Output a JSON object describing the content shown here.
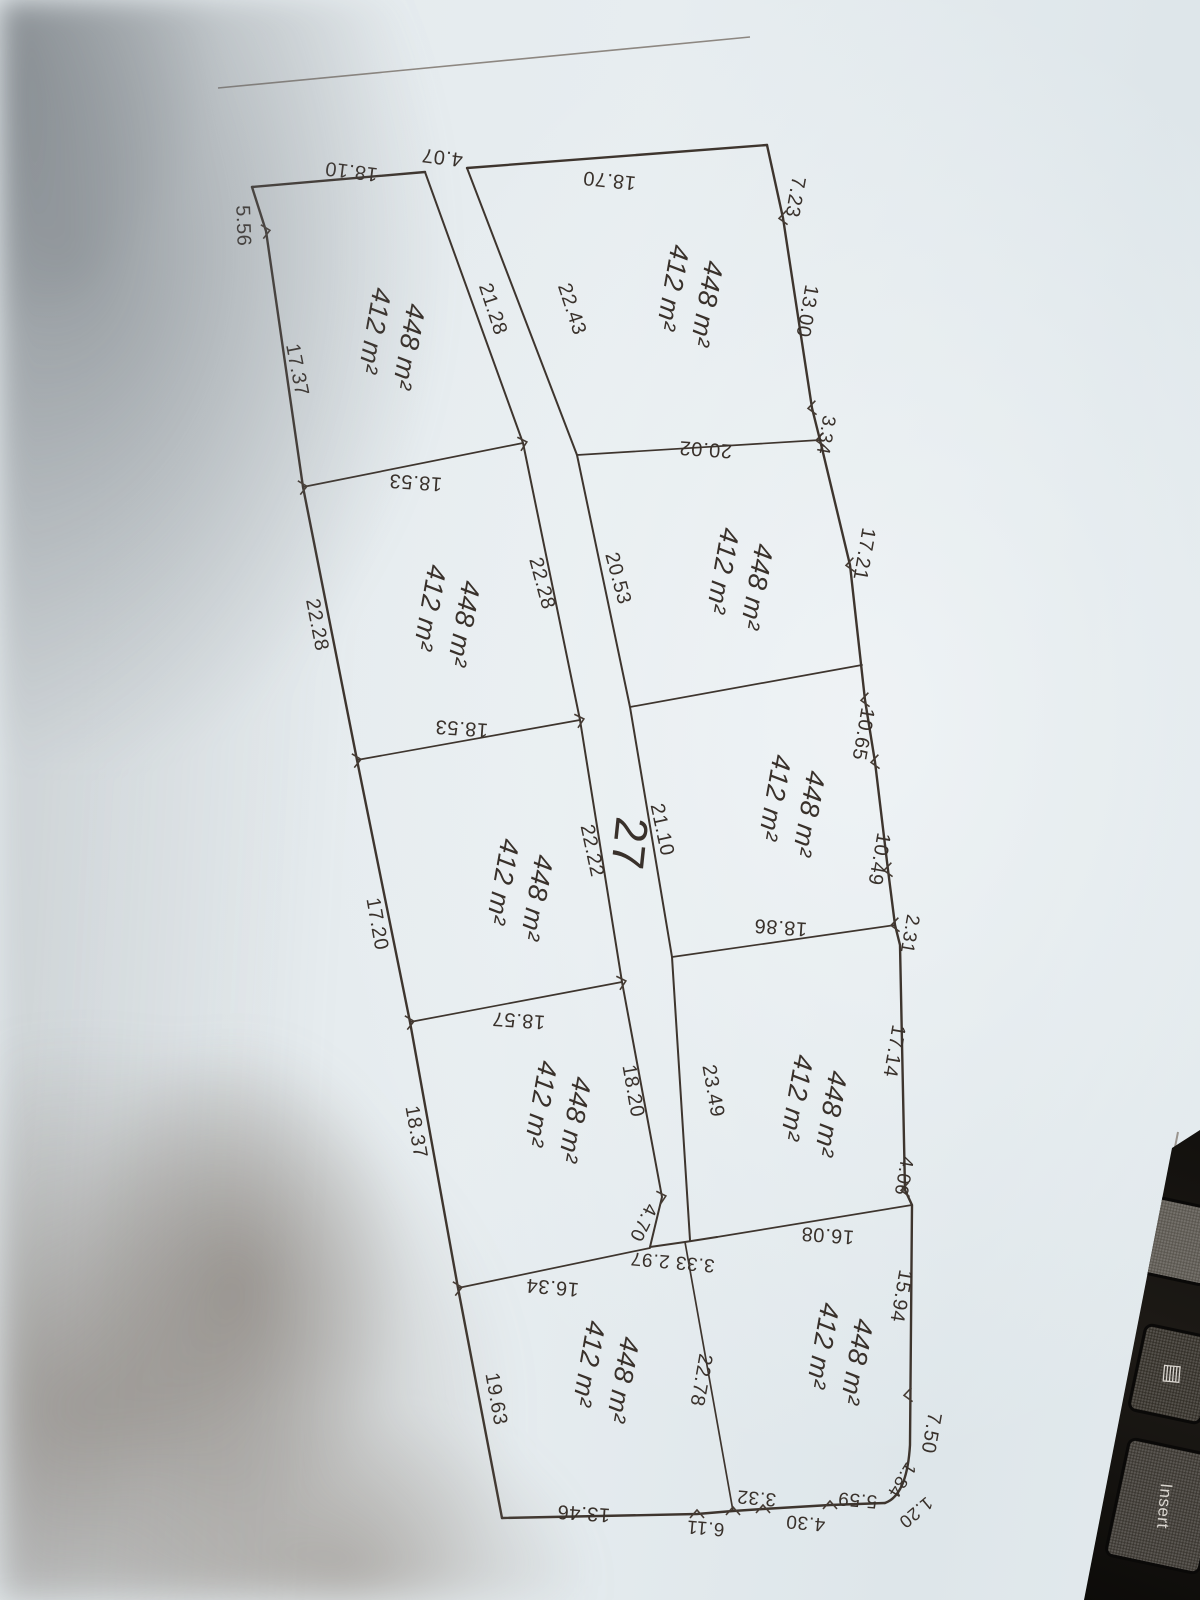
{
  "photo": {
    "paper_color": "#e6ecef",
    "ink_color": "#39312b",
    "shadow_top_left_color": "#62686e",
    "shadow_bottom_left_color": "#746a61",
    "keyboard_color": "#14110e"
  },
  "plan": {
    "road_number": {
      "text": "27",
      "x": 614,
      "y": 842,
      "r": 96,
      "size": 46
    },
    "parcels": [
      {
        "id": "left-1",
        "area_gross": "448 m²",
        "area_net": "412 m²",
        "x": 400,
        "y": 345,
        "r": 100
      },
      {
        "id": "left-2",
        "area_gross": "448 m²",
        "area_net": "412 m²",
        "x": 455,
        "y": 622,
        "r": 100
      },
      {
        "id": "left-3",
        "area_gross": "448 m²",
        "area_net": "412 m²",
        "x": 528,
        "y": 896,
        "r": 100
      },
      {
        "id": "left-4",
        "area_gross": "448 m²",
        "area_net": "412 m²",
        "x": 566,
        "y": 1118,
        "r": 100
      },
      {
        "id": "left-5",
        "area_gross": "448 m²",
        "area_net": "412 m²",
        "x": 614,
        "y": 1378,
        "r": 100
      },
      {
        "id": "right-1",
        "area_gross": "448 m²",
        "area_net": "412 m²",
        "x": 698,
        "y": 302,
        "r": 100
      },
      {
        "id": "right-2",
        "area_gross": "448 m²",
        "area_net": "412 m²",
        "x": 748,
        "y": 585,
        "r": 100
      },
      {
        "id": "right-3",
        "area_gross": "448 m²",
        "area_net": "412 m²",
        "x": 800,
        "y": 812,
        "r": 100
      },
      {
        "id": "right-4",
        "area_gross": "448 m²",
        "area_net": "412 m²",
        "x": 822,
        "y": 1112,
        "r": 100
      },
      {
        "id": "right-5",
        "area_gross": "448 m²",
        "area_net": "412 m²",
        "x": 848,
        "y": 1360,
        "r": 100
      }
    ],
    "dimension_labels": [
      {
        "text": "18.10",
        "x": 352,
        "y": 165,
        "r": 187
      },
      {
        "text": "4.07",
        "x": 443,
        "y": 151,
        "r": 187
      },
      {
        "text": "18.70",
        "x": 610,
        "y": 174,
        "r": 186
      },
      {
        "text": "7.23",
        "x": 789,
        "y": 196,
        "r": 100
      },
      {
        "text": "13.00",
        "x": 801,
        "y": 310,
        "r": 100
      },
      {
        "text": "3.34",
        "x": 820,
        "y": 434,
        "r": 100,
        "size": 19
      },
      {
        "text": "17.21",
        "x": 858,
        "y": 553,
        "r": 100
      },
      {
        "text": "10.65",
        "x": 857,
        "y": 733,
        "r": 100
      },
      {
        "text": "10.49",
        "x": 873,
        "y": 858,
        "r": 100
      },
      {
        "text": "2.31",
        "x": 904,
        "y": 933,
        "r": 100,
        "size": 19
      },
      {
        "text": "17.14",
        "x": 888,
        "y": 1050,
        "r": 100
      },
      {
        "text": "4.06",
        "x": 898,
        "y": 1175,
        "r": 100,
        "size": 19
      },
      {
        "text": "15.94",
        "x": 895,
        "y": 1295,
        "r": 100
      },
      {
        "text": "7.50",
        "x": 925,
        "y": 1432,
        "r": 100
      },
      {
        "text": "1.84",
        "x": 897,
        "y": 1477,
        "r": 122,
        "size": 18
      },
      {
        "text": "1.20",
        "x": 912,
        "y": 1508,
        "r": 140,
        "size": 18
      },
      {
        "text": "5.59",
        "x": 858,
        "y": 1494,
        "r": 185,
        "size": 19
      },
      {
        "text": "4.30",
        "x": 806,
        "y": 1517,
        "r": 185,
        "size": 19
      },
      {
        "text": "3.32",
        "x": 757,
        "y": 1492,
        "r": 185,
        "size": 19
      },
      {
        "text": "6.11",
        "x": 706,
        "y": 1522,
        "r": 185,
        "size": 19
      },
      {
        "text": "13.46",
        "x": 584,
        "y": 1507,
        "r": 184
      },
      {
        "text": "19.63",
        "x": 490,
        "y": 1400,
        "r": 80
      },
      {
        "text": "18.37",
        "x": 410,
        "y": 1133,
        "r": 80
      },
      {
        "text": "17.20",
        "x": 371,
        "y": 925,
        "r": 80
      },
      {
        "text": "22.28",
        "x": 311,
        "y": 626,
        "r": 79
      },
      {
        "text": "17.37",
        "x": 291,
        "y": 371,
        "r": 79
      },
      {
        "text": "5.56",
        "x": 237,
        "y": 226,
        "r": 88
      },
      {
        "text": "21.28",
        "x": 487,
        "y": 311,
        "r": 72
      },
      {
        "text": "22.43",
        "x": 566,
        "y": 311,
        "r": 72
      },
      {
        "text": "20.02",
        "x": 706,
        "y": 443,
        "r": 184
      },
      {
        "text": "18.53",
        "x": 416,
        "y": 476,
        "r": 184
      },
      {
        "text": "18.53",
        "x": 462,
        "y": 722,
        "r": 184
      },
      {
        "text": "20.53",
        "x": 612,
        "y": 580,
        "r": 75
      },
      {
        "text": "22.28",
        "x": 536,
        "y": 585,
        "r": 75
      },
      {
        "text": "22.22",
        "x": 586,
        "y": 852,
        "r": 78
      },
      {
        "text": "21.10",
        "x": 656,
        "y": 831,
        "r": 78
      },
      {
        "text": "18.57",
        "x": 519,
        "y": 1014,
        "r": 184
      },
      {
        "text": "18.86",
        "x": 781,
        "y": 921,
        "r": 184
      },
      {
        "text": "18.20",
        "x": 627,
        "y": 1092,
        "r": 80
      },
      {
        "text": "23.49",
        "x": 707,
        "y": 1092,
        "r": 80
      },
      {
        "text": "16.08",
        "x": 828,
        "y": 1229,
        "r": 184
      },
      {
        "text": "16.34",
        "x": 553,
        "y": 1281,
        "r": 185
      },
      {
        "text": "4.70",
        "x": 638,
        "y": 1220,
        "r": 116,
        "size": 19
      },
      {
        "text": "3.33 2.97",
        "x": 673,
        "y": 1256,
        "r": 185,
        "size": 19
      },
      {
        "text": "22.78",
        "x": 695,
        "y": 1379,
        "r": 100
      }
    ],
    "ticks": [
      {
        "x": 266,
        "y": 231,
        "r": 260
      },
      {
        "x": 303,
        "y": 487,
        "r": 260
      },
      {
        "x": 357,
        "y": 760,
        "r": 260
      },
      {
        "x": 410,
        "y": 1022,
        "r": 260
      },
      {
        "x": 458,
        "y": 1288,
        "r": 260
      },
      {
        "x": 783,
        "y": 218,
        "r": 85
      },
      {
        "x": 812,
        "y": 408,
        "r": 85
      },
      {
        "x": 820,
        "y": 440,
        "r": 85
      },
      {
        "x": 850,
        "y": 565,
        "r": 85
      },
      {
        "x": 865,
        "y": 700,
        "r": 85
      },
      {
        "x": 875,
        "y": 762,
        "r": 85
      },
      {
        "x": 888,
        "y": 870,
        "r": 85
      },
      {
        "x": 895,
        "y": 925,
        "r": 85
      },
      {
        "x": 905,
        "y": 1190,
        "r": 85
      },
      {
        "x": 908,
        "y": 1395,
        "r": 85
      },
      {
        "x": 830,
        "y": 1505,
        "r": 180
      },
      {
        "x": 763,
        "y": 1509,
        "r": 180
      },
      {
        "x": 733,
        "y": 1511,
        "r": 180
      },
      {
        "x": 697,
        "y": 1514,
        "r": 180
      },
      {
        "x": 523,
        "y": 443,
        "r": 255
      },
      {
        "x": 580,
        "y": 720,
        "r": 255
      },
      {
        "x": 622,
        "y": 982,
        "r": 255
      },
      {
        "x": 662,
        "y": 1197,
        "r": 255
      }
    ]
  },
  "keyboard": {
    "insert_key": "Insert",
    "menu_icon": "▤"
  }
}
